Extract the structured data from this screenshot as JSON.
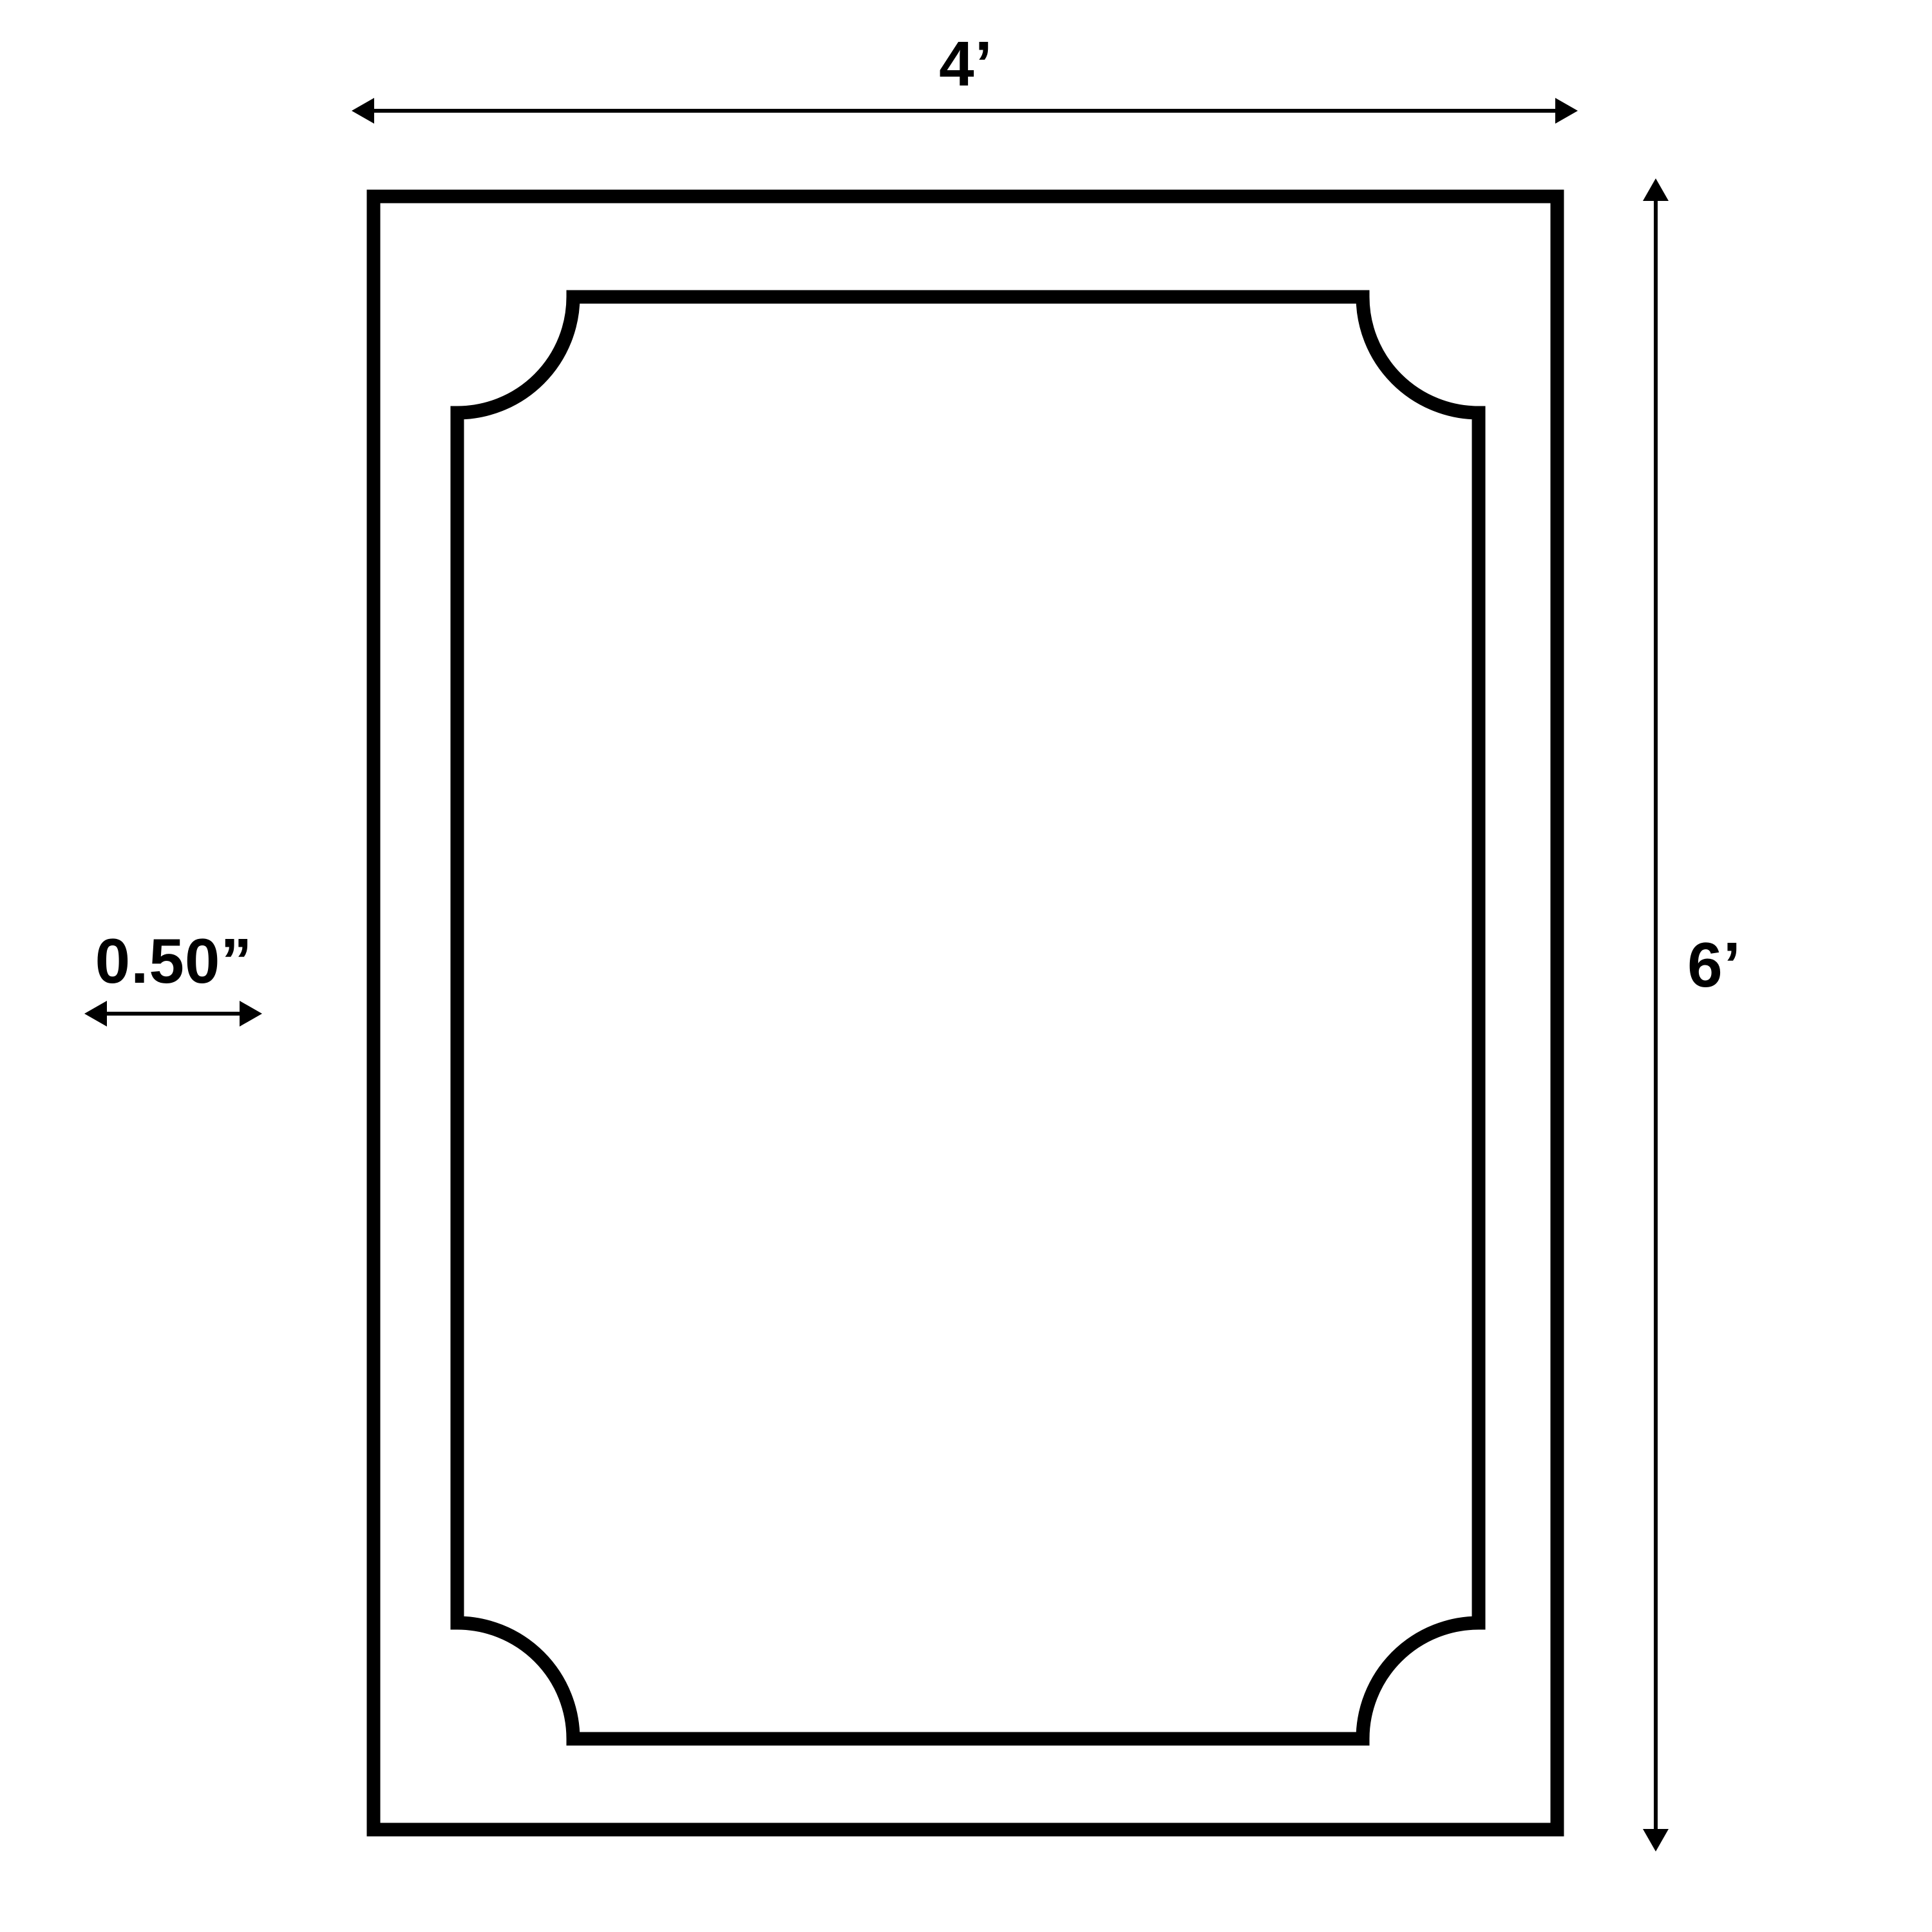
{
  "diagram": {
    "type": "dimension-drawing",
    "subject": "rectangular panel with inner frame outline with notched corners",
    "colors": {
      "ink": "#000000",
      "background": "#ffffff"
    },
    "dimensions": {
      "width": {
        "value": "4’",
        "orientation": "horizontal",
        "position": "top"
      },
      "height": {
        "value": "6’",
        "orientation": "vertical",
        "position": "right"
      },
      "thickness": {
        "value": "0.50”",
        "orientation": "horizontal",
        "position": "left"
      }
    }
  }
}
